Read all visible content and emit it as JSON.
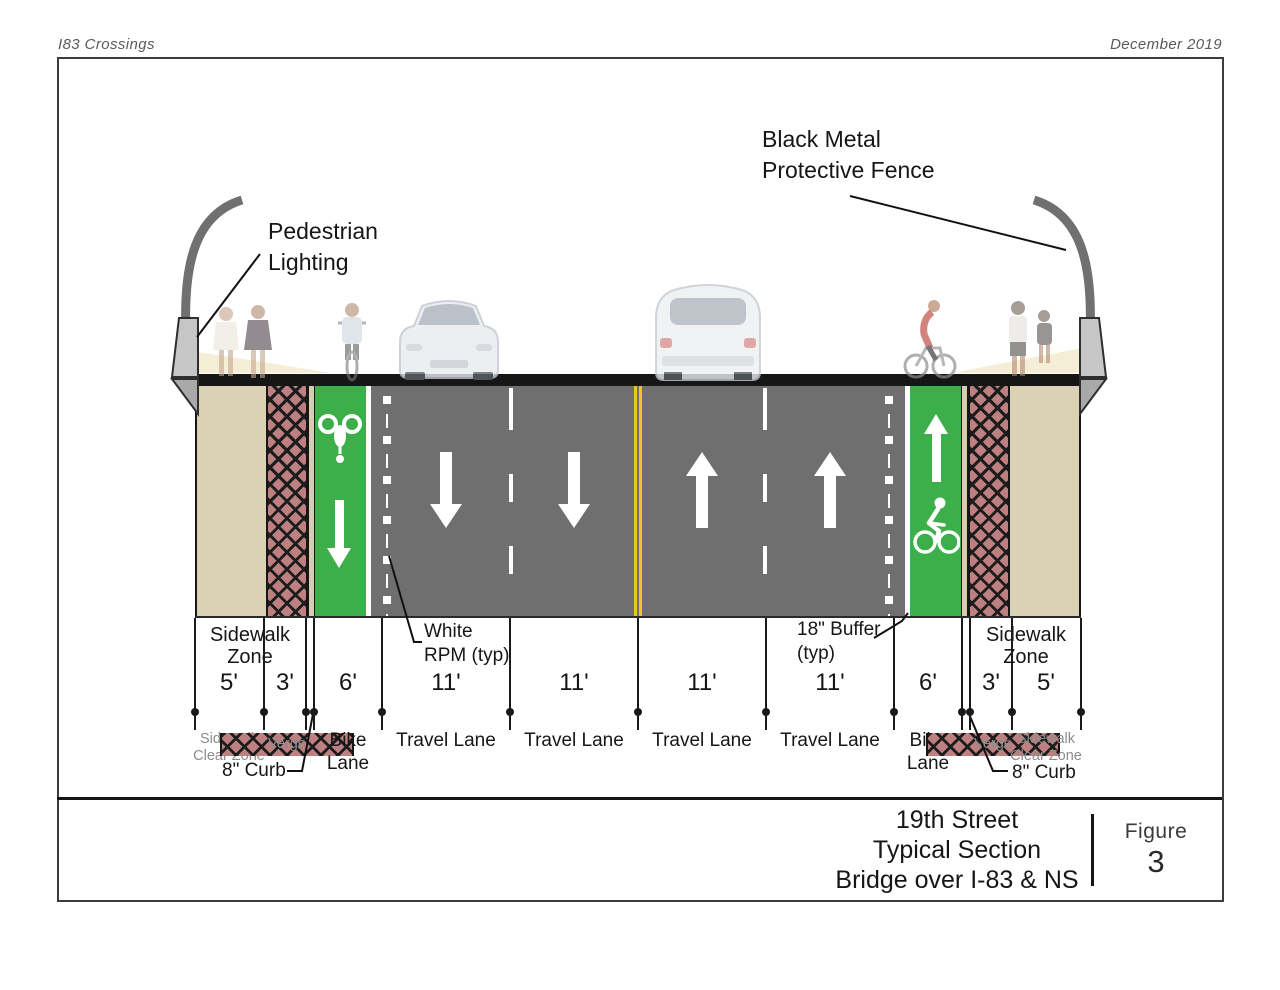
{
  "header": {
    "project": "I83 Crossings",
    "date": "December 2019"
  },
  "callouts": {
    "pedestrian_lighting": "Pedestrian\nLighting",
    "protective_fence": "Black Metal\nProtective Fence",
    "white_rpm": "White\nRPM (typ)",
    "buffer": "18\" Buffer\n(typ)",
    "curb_left": "8\" Curb",
    "curb_right": "8\" Curb"
  },
  "section": {
    "sidewalk_zone_left": "Sidewalk\nZone",
    "sidewalk_zone_right": "Sidewalk\nZone",
    "dims": [
      {
        "w": "5'",
        "label": "Sidewalk\nClear Zone"
      },
      {
        "w": "3'",
        "label": "Verge"
      },
      {
        "w": "6'",
        "label": "Bike\nLane"
      },
      {
        "w": "11'",
        "label": "Travel Lane"
      },
      {
        "w": "11'",
        "label": "Travel Lane"
      },
      {
        "w": "11'",
        "label": "Travel Lane"
      },
      {
        "w": "11'",
        "label": "Travel Lane"
      },
      {
        "w": "6'",
        "label": "Bike\nLane"
      },
      {
        "w": "3'",
        "label": "Verge"
      },
      {
        "w": "5'",
        "label": "Sidewalk\nClear Zone"
      }
    ]
  },
  "title_block": {
    "title": "19th Street\nTypical Section\nBridge over I-83 & NS",
    "figure_label": "Figure",
    "figure_number": "3"
  },
  "colors": {
    "bike_lane_green": "#3caf4a",
    "road_gray": "#6f6f6f",
    "verge_red": "#bd7f7f",
    "sidewalk_tan": "#dbd1b4",
    "center_line_yellow": "#edc71a",
    "deck_black": "#161616"
  }
}
